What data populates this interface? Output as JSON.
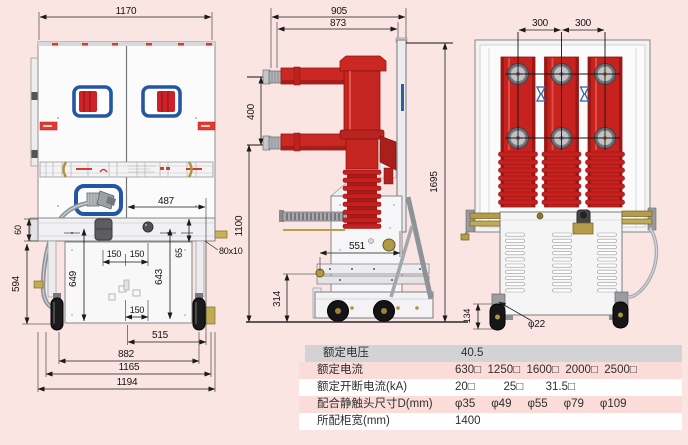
{
  "colors": {
    "background": "#fae5e3",
    "equipment_red": "#c8221f",
    "frame_blue": "#2456a4",
    "dim_line": "#1a1a1a",
    "table_header_gray": "#d3d3d5",
    "table_row_pink": "#fbdcd8",
    "brass": "#b49c4c"
  },
  "dims": {
    "front": {
      "width_top": "1170",
      "center_to_side": "487",
      "busbar_section": "80x10",
      "beam_height": "60",
      "frame_height": "594",
      "left_inner_height": "649",
      "right_inner_height": "643",
      "slot_height": "65",
      "spacing_150": "150",
      "span_515": "515",
      "wheelbase_882": "882",
      "frame_width_1165": "1165",
      "overall_width_1194": "1194"
    },
    "side": {
      "depth_905": "905",
      "depth_873": "873",
      "pole_pitch_400": "400",
      "height_1695": "1695",
      "lower_arm_height_1100": "1100",
      "pin_offset_551": "551",
      "pin_height_314": "314"
    },
    "rear": {
      "phase_pitch_left": "300",
      "phase_pitch_right": "300",
      "wheel_height_134": "134",
      "wheel_dia": "φ22"
    }
  },
  "table": {
    "rows": [
      {
        "label": "额定电压",
        "value": "40.5"
      },
      {
        "label": "额定电流",
        "value": "630□  1250□  1600□  2000□  2500□"
      },
      {
        "label": "额定开断电流(kA)",
        "value": "20□         25□       31.5□"
      },
      {
        "label": "配合静触头尺寸D(mm)",
        "value": "φ35     φ49     φ55     φ79     φ109"
      },
      {
        "label": "所配柜宽(mm)",
        "value": "1400"
      }
    ]
  }
}
